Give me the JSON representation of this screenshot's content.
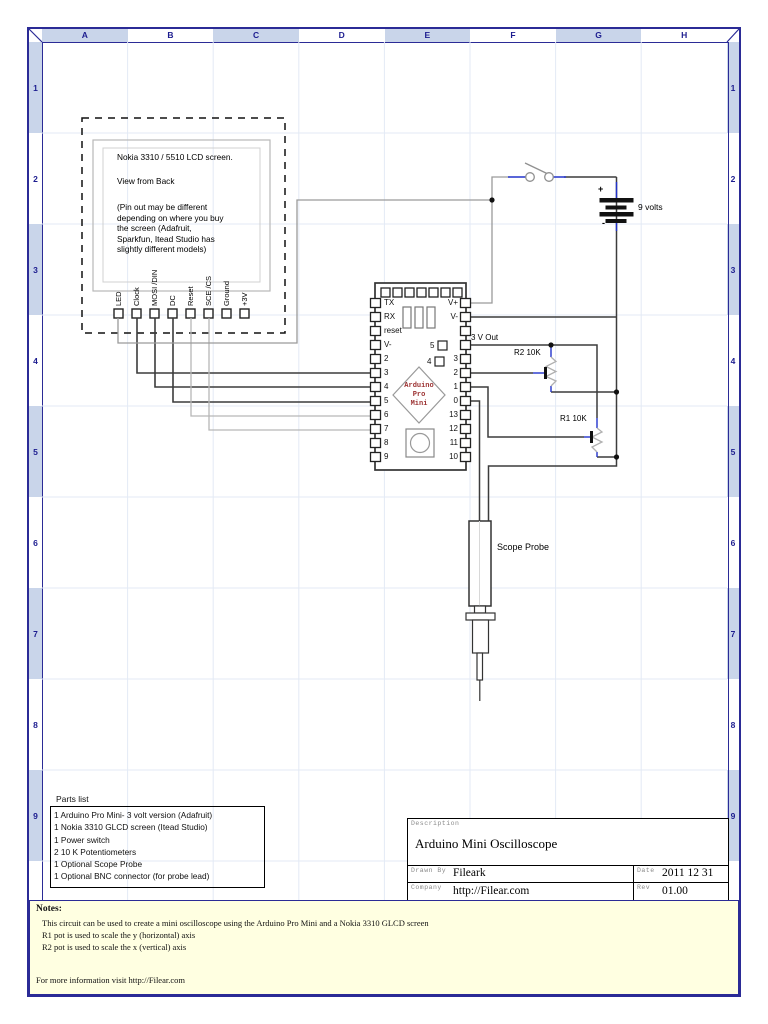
{
  "grid": {
    "cols": [
      "A",
      "B",
      "C",
      "D",
      "E",
      "F",
      "G",
      "H"
    ],
    "rows": [
      "1",
      "2",
      "3",
      "4",
      "5",
      "6",
      "7",
      "8",
      "9"
    ]
  },
  "lcd": {
    "title": "Nokia 3310 / 5510 LCD screen.",
    "subtitle": "View from Back",
    "note": "(Pin out may be different\ndepending on where you buy\nthe screen (Adafruit,\nSparkfun, Itead Studio has\nslightly different models)",
    "pins": [
      "LED",
      "Clock",
      "MOSI /DIN",
      "DC",
      "Reset",
      "SCE /CS",
      "Ground",
      "+3V"
    ]
  },
  "arduino": {
    "left_pins": [
      "TX",
      "RX",
      "reset",
      "V-",
      "2",
      "3",
      "4",
      "5",
      "6",
      "7",
      "8",
      "9"
    ],
    "right_pins": [
      "V+",
      "V-",
      "",
      "",
      "3",
      "2",
      "1",
      "0",
      "13",
      "12",
      "11",
      "10"
    ],
    "inner_pin_5": "5",
    "inner_pin_4": "4",
    "chip_label": "Arduino\nPro\nMini"
  },
  "labels": {
    "v_out": "3 V Out",
    "r2": "R2 10K",
    "r1": "R1 10K",
    "battery": "9 volts",
    "battery_plus": "+",
    "battery_minus": "-",
    "scope_probe": "Scope Probe"
  },
  "parts_list": {
    "title": "Parts list",
    "items": [
      "1 Arduino Pro Mini- 3 volt version (Adafruit)",
      "1 Nokia 3310 GLCD screen (Itead Studio)",
      "1 Power switch",
      "2 10 K Potentiometers",
      "1 Optional Scope Probe",
      "1 Optional BNC connector (for probe lead)"
    ]
  },
  "title_block": {
    "description_label": "Description",
    "description": "Arduino Mini Oscilloscope",
    "drawn_by_label": "Drawn By",
    "drawn_by": "Fileark",
    "date_label": "Date",
    "date": "2011 12 31",
    "company_label": "Company",
    "company": "http://Filear.com",
    "rev_label": "Rev",
    "rev": "01.00"
  },
  "notes": {
    "heading": "Notes:",
    "lines": [
      "This circuit can be used to create a mini oscilloscope using the Arduino Pro Mini and a Nokia 3310 GLCD screen",
      "R1 pot is used to scale the y (horizontal) axis",
      "R2 pot is used to scale the x (vertical) axis"
    ],
    "footer": "For more information visit http://Filear.com"
  },
  "colors": {
    "frame_navy": "#2b2b96",
    "band_blue": "#c9d5ea",
    "notes_bg": "#ffffe1",
    "wire_dark": "#3c3c3c",
    "wire_light": "#b6b6b6",
    "wire_gray": "#9a9a9a",
    "accent_blue": "#2233cc"
  }
}
